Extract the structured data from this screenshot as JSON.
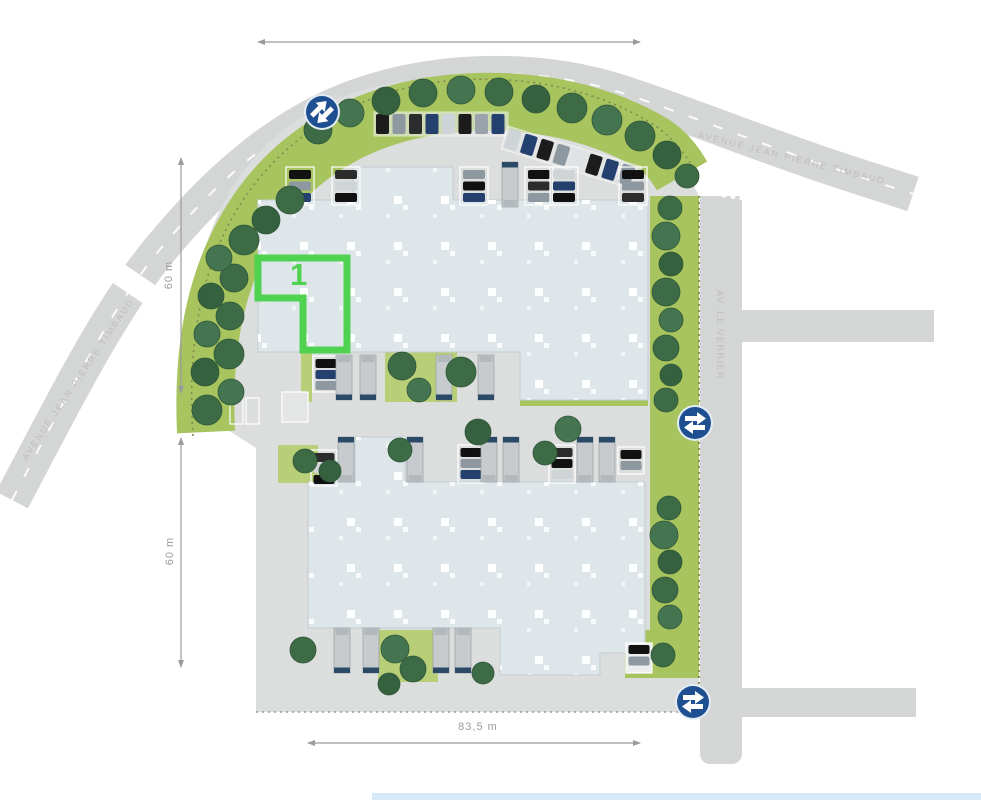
{
  "plan": {
    "unit_label": "1",
    "streets": {
      "avenue_top": "AVENUE JEAN PIERRE TIMBAUD",
      "avenue_left": "AVENUE JEAN PIERRE TIMBAUD",
      "avenue_right": "AV. LE VERRIER"
    },
    "dimensions": {
      "left_upper": "60 m",
      "left_lower": "60 m",
      "bottom": "83,5 m"
    },
    "colors": {
      "road": "#d4d5d5",
      "pavement": "#dcdddd",
      "grass": "#a7c45f",
      "tree_dark": "#3c6b46",
      "building": "#dfe6ea",
      "unit_outline": "#4fd24f",
      "sign_blue": "#1e4f91",
      "dimension_text": "#9b9b9b",
      "truck_cab": "#2b4a68"
    }
  }
}
